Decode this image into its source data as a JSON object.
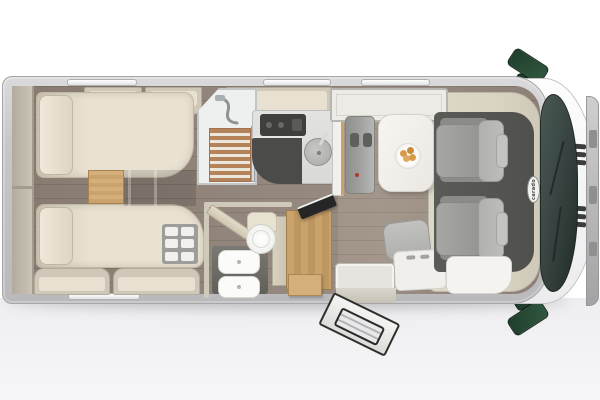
{
  "scene": {
    "title": "motorhome-floorplan-top-view",
    "brand_badge": "carado"
  },
  "colors": {
    "bg-bottom": "#eeeef0",
    "wall": "#c7c7c9",
    "wall-light": "#dadadc",
    "wall-edge": "#a6a6a8",
    "floor-wood": "#92857b",
    "locker": "#cfc7b8",
    "locker-face": "#e8e1d2",
    "cream": "#e9e2d2",
    "cream-dark": "#d2cab9",
    "cream-line": "#c0b7a4",
    "wood": "#c9a26c",
    "wood-light": "#d4af7c",
    "slat": "#b5835a",
    "slat-gap": "#ece7dd",
    "counter": "#d9d9d7",
    "appliance-dark": "#4b4b49",
    "seat-gray": "#9e9e9c",
    "seat-gray-light": "#b7b7b5",
    "seat-gray-dark": "#8b8b89",
    "cab-floor": "#50504c",
    "trim": "#d9d3c3",
    "glass": "#3d4a48",
    "glass-dark": "#2c3834",
    "green": "#1f3d2c",
    "green-light": "#315940",
    "metal": "#cfcfd1",
    "basin-panel": "#7a7974",
    "tan": "#d79a4c",
    "red-accent": "#b03a2e",
    "tv": "#262626"
  },
  "zones": {
    "rear": [
      "rear-storage-shelf",
      "twin-bed-top",
      "twin-bed-bottom",
      "bed-steps",
      "shoe-rack"
    ],
    "middle": [
      "shower",
      "washroom-door",
      "toilet",
      "washbasin",
      "wardrobe",
      "tv",
      "kitchen-counter",
      "hob",
      "sink",
      "fridge"
    ],
    "front": [
      "dinette-bench",
      "dinette-table",
      "plate-of-food",
      "travel-seat",
      "entry-door",
      "entry-step",
      "cab-seat-driver",
      "cab-seat-passenger",
      "dashboard",
      "windshield",
      "side-mirrors",
      "brand-badge"
    ]
  }
}
